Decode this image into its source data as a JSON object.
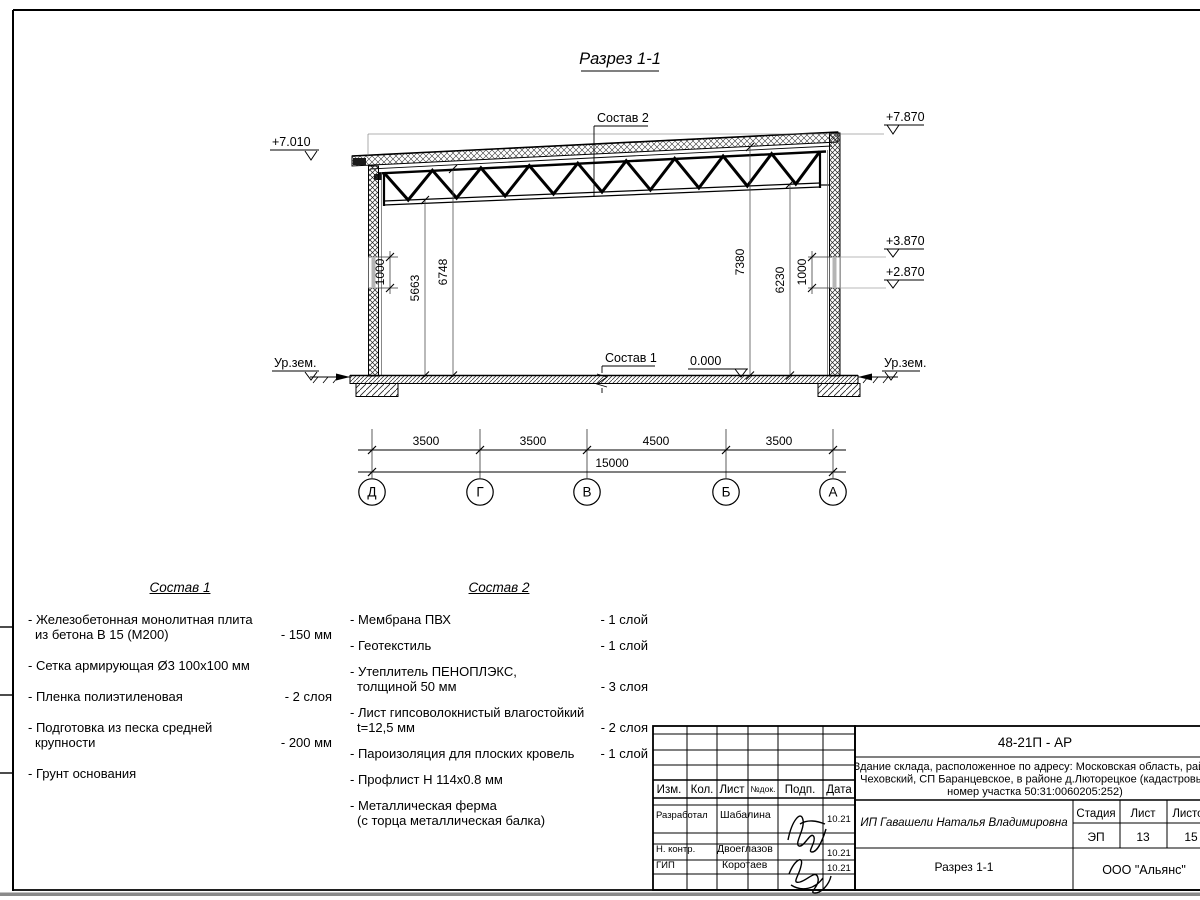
{
  "sheet": {
    "title": "Разрез 1-1"
  },
  "section": {
    "label_sostav2": "Состав 2",
    "label_sostav1": "Состав 1",
    "elev_left_top": "+7.010",
    "elev_right_top": "+7.870",
    "elev_right_upper": "+3.870",
    "elev_right_lower": "+2.870",
    "elev_zero": "0.000",
    "ground_left": "Ур.зем.",
    "ground_right": "Ур.зем.",
    "vdims": [
      "1000",
      "5663",
      "6748",
      "7380",
      "6230",
      "1000"
    ],
    "axis_spans": [
      "3500",
      "3500",
      "4500",
      "3500"
    ],
    "total_span": "15000",
    "axes": [
      "Д",
      "Г",
      "В",
      "Б",
      "А"
    ]
  },
  "sostav1": {
    "title": "Состав 1",
    "items": [
      {
        "line1": "- Железобетонная  монолитная плита",
        "line2": "из бетона В 15 (М200)",
        "value": "- 150 мм"
      },
      {
        "line1": "- Сетка армирующая Ø3 100х100 мм",
        "line2": "",
        "value": ""
      },
      {
        "line1": "- Пленка полиэтиленовая",
        "line2": "",
        "value": "-  2 слоя"
      },
      {
        "line1": "- Подготовка из песка средней",
        "line2": "крупности",
        "value": "- 200 мм"
      },
      {
        "line1": "- Грунт основания",
        "line2": "",
        "value": ""
      }
    ]
  },
  "sostav2": {
    "title": "Состав 2",
    "items": [
      {
        "line1": "- Мембрана ПВХ",
        "line2": "",
        "value": "- 1 слой"
      },
      {
        "line1": "- Геотекстиль",
        "line2": "",
        "value": "- 1 слой"
      },
      {
        "line1": "- Утеплитель ПЕНОПЛЭКС,",
        "line2": "толщиной 50 мм",
        "value": "- 3 слоя"
      },
      {
        "line1": "- Лист гипсоволокнистый влагостойкий",
        "line2": "t=12,5 мм",
        "value": "- 2 слоя"
      },
      {
        "line1": "- Пароизоляция для плоских кровель",
        "line2": "",
        "value": "- 1 слой"
      },
      {
        "line1": "- Профлист Н 114х0.8 мм",
        "line2": "",
        "value": ""
      },
      {
        "line1": "- Металлическая ферма",
        "line2": "(с торца металлическая балка)",
        "value": ""
      }
    ]
  },
  "titleblock": {
    "code": "48-21П - АР",
    "description": [
      "Здание склада, расположенное по адресу: Московская область, район",
      "Чеховский, СП Баранцевское, в районе д.Люторецкое  (кадастровый",
      "номер участка 50:31:0060205:252)"
    ],
    "header_cols": [
      "Изм.",
      "Кол.",
      "Лист",
      "№док.",
      "Подп.",
      "Дата"
    ],
    "rows": [
      {
        "role": "Разработал",
        "name": "Шабалина",
        "date": "10.21"
      },
      {
        "role": "Н. контр.",
        "name": "Двоеглазов",
        "date": "10.21"
      },
      {
        "role": "ГИП",
        "name": "Коротаев",
        "date": "10.21"
      }
    ],
    "client": "ИП Гавашели Наталья Владимировна",
    "stage_label": "Стадия",
    "sheet_label": "Лист",
    "sheets_label": "Листов",
    "stage": "ЭП",
    "sheet_no": "13",
    "sheets_total": "15",
    "doc_name": "Разрез 1-1",
    "company": "ООО \"Альянс\""
  }
}
